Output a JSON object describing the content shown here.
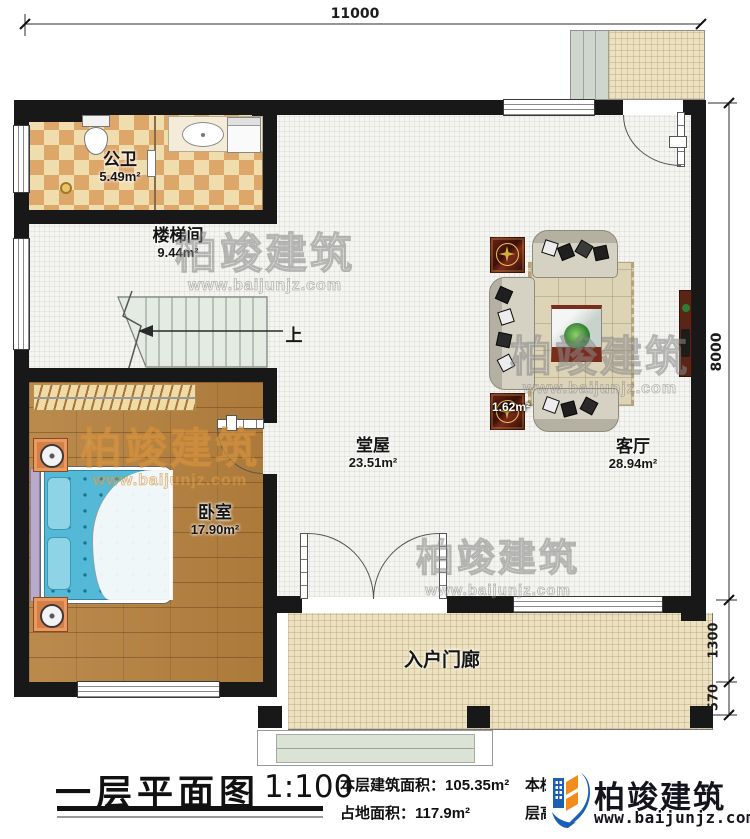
{
  "plan": {
    "dimensions": {
      "width_mm": "11000",
      "height_mm": "8000",
      "porch_depth_mm": "1300",
      "steps_depth_mm": "570"
    },
    "rooms": {
      "bathroom": {
        "name": "公卫",
        "area": "5.49m²"
      },
      "stair": {
        "name": "楼梯间",
        "area": "9.44m²"
      },
      "bedroom": {
        "name": "卧室",
        "area": "17.90m²"
      },
      "hall": {
        "name": "堂屋",
        "area": "23.51m²"
      },
      "living": {
        "name": "客厅",
        "area": "28.94m²"
      },
      "porch": {
        "name": "入户门廊"
      },
      "misc_area": "1.62m²",
      "stair_direction": "上"
    }
  },
  "title_block": {
    "title": "一层平面图",
    "scale": "1:100",
    "floor_area_label": "本层建筑面积：",
    "floor_area": "105.35m²",
    "land_area_label": "占地面积：",
    "land_area": "117.9m²",
    "building_area_label": "本栋建筑面积：",
    "storey_height_label": "层高：",
    "storey_height": "3.9m"
  },
  "branding": {
    "watermark_name": "柏竣建筑",
    "watermark_site": "www.baijunjz.com",
    "logo_name": "柏竣建筑",
    "logo_site": "www.baijunjz.com"
  },
  "colors": {
    "wall": "#181818",
    "wood_floor": "#b5813e",
    "bath_tile_light": "#f0ddae",
    "bath_tile_dark": "#dea76a",
    "porch_tile": "#ece2c2",
    "bed_blue": "#54b9d6",
    "logo_blue": "#1a5fb4",
    "logo_orange": "#f08c1e"
  }
}
